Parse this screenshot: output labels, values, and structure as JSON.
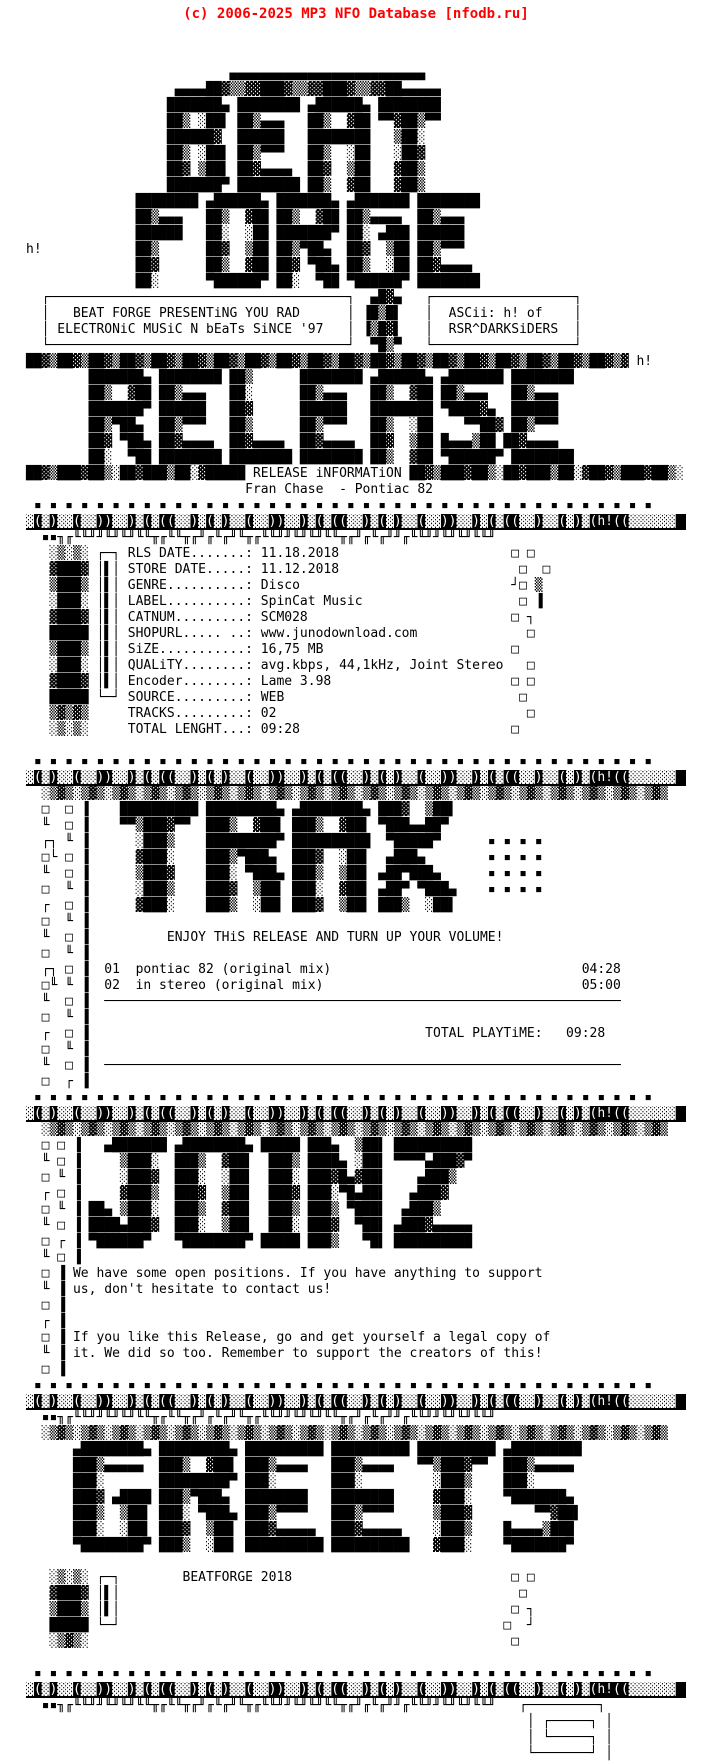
{
  "header": {
    "copyright": "(c) 2006-2025 MP3 NFO Database [nfodb.ru]",
    "color": "#ff0000"
  },
  "colors": {
    "ink": "#000000",
    "paper": "#ffffff",
    "header_red": "#ff0000"
  },
  "ascii_credit": {
    "banner_words": [
      "beat",
      "forge",
      "release",
      "trax",
      "joinz",
      "greets"
    ],
    "artist_tag": "h!",
    "ascii_by": "ASCii: h! of",
    "group": "RSR^DARKSiDERS"
  },
  "intro": {
    "line1": "BEAT FORGE PRESENTiNG YOU RAD",
    "line2": "ELECTRONiC MUSiC N bEaTs SiNCE '97"
  },
  "release": {
    "section_label": "RELEASE iNFORMATiON",
    "artist": "Fran Chase",
    "title": "Pontiac 82",
    "fields": [
      {
        "label": "RLS DATE",
        "value": "11.18.2018"
      },
      {
        "label": "STORE DATE",
        "value": "11.12.2018"
      },
      {
        "label": "GENRE",
        "value": "Disco"
      },
      {
        "label": "LABEL",
        "value": "SpinCat Music"
      },
      {
        "label": "CATNUM",
        "value": "SCM028"
      },
      {
        "label": "SHOPURL",
        "value": "www.junodownload.com"
      },
      {
        "label": "SiZE",
        "value": "16,75 MB"
      },
      {
        "label": "QUALiTY",
        "value": "avg.kbps, 44,1kHz, Joint Stereo"
      },
      {
        "label": "Encoder",
        "value": "Lame 3.98"
      },
      {
        "label": "SOURCE",
        "value": "WEB"
      },
      {
        "label": "TRACKS",
        "value": "02"
      },
      {
        "label": "TOTAL LENGHT",
        "value": "09:28"
      }
    ]
  },
  "tracklist": {
    "header": "ENJOY THiS RELEASE AND TURN UP YOUR VOLUME!",
    "tracks": [
      {
        "no": "01",
        "title": "pontiac 82 (original mix)",
        "time": "04:28"
      },
      {
        "no": "02",
        "title": "in stereo (original mix)",
        "time": "05:00"
      }
    ],
    "total_label": "TOTAL PLAYTiME:",
    "total_time": "09:28"
  },
  "joins": {
    "para1_line1": "We have some open positions. If you have anything to support",
    "para1_line2": "us, don't hesitate to contact us!",
    "para2_line1": "If you like this Release, go and get yourself a legal copy of",
    "para2_line2": "it. We did so too. Remember to support the creators of this!"
  },
  "greets": {
    "footer": "BEATFORGE 2018"
  },
  "nfo": {
    "inverse_lines": [
      29,
      45,
      66,
      84,
      102
    ],
    "lines": [
      "",
      "                          ▄▄▄▄▄▄▄▄▄▄▄▄▄▄▄▄▄▄▄▄▄▄▄▄▄",
      "                   ▄▄▄▄██▓▒▒▓▓███▓▒▒▓▓███▓▒▒▓▓██▄▄▄▄▄",
      "                  ███████▄ ████████ ▄██████▄ ████████",
      "                  ██▒ ░██▌ ██▒▄▄▄   ██▒  ▓██ ▀▀▓██▒▀▀",
      "                  ██████▓  ██████   ████████   ▒██░",
      "                  ██▒ ░██▌ ██▒▀▀▀   ██▒  ░██   ░██▓",
      "                  ██▓ ▒██▌ ██▓▄▄▄▄  ██▓  ▒██   ▓██▒",
      "                  ███████▀ ████████ ██▒  ▓██   ▓██▒",
      "              ████████ ▄██████▄ ███████▄ ▄███████ ████████",
      "              ██▒▄▄▄   ██▒  ▓██ ██▒  ▓██ ██▒▄▄▄▄  ██▒▄▄▄",
      "              ██████   ██░  ░██ ███████▀ ██░ ▄███ ██████",
      "h!            ██▒      ██▓  ▒██ ██▒▀██▄  ██▓  ▒██ ██▒▀▀▀",
      "              ██▓      ██▒  ▓██ ██▓ ▀██▄ ██▒  ░██ ██▓▄▄▄▄",
      "              ██░      ▀██████▀ ██░  ▀██ ▀██████▀ ████████",
      "  ┌──────────────────────────────────────┐  ▄█▓▄   ┌──────────────────┐",
      "  │   BEAT FORGE PRESENTiNG YOU RAD      │ ▐█▒█▌   │  ASCii: h! of    │",
      "  │ ELECTRONiC MUSiC N bEaTs SiNCE '97   │ ▐▒█▓▌   │  RSR^DARKSiDERS  │",
      "  └──────────────────────────────────────┘  ▀█▒▀   └──────────────────┘",
      "██▓▒██▓▒██▓▒██▓▒██▓▒██▓▒██▓▒██▓▒██▓▒██▓▒██▓▒██▓▒██▓▒██▓▒██▓▒██▓▒██▓▒██▓▒██▓▒▓ h!",
      "        ███████▄ ████████ ██▒      ████████ ▄██████▄ ▄███████ ████████",
      "        ██▒  ▓██ ██▒▄▄▄   ██░      ██▒▄▄▄   ██▒  ▓██ ██▒▄▄▄   ██▒▄▄▄",
      "        ███████▀ ██████   ██▓      ██████   ████████ ▀████▓▄  ██████",
      "        ██▒▀██▄  ██▒▀▀▀   ██▒      ██▒▀▀▀   ██▒  ░██    ▀▀██▓ ██▒▀▀▀",
      "        ██▓ ▀██▄ ██▓▄▄▄▄  ██▓▄▄▄▄  ██▓▄▄▄▄  ██▓  ▒██ █▄▄▄▒██ ██▓▄▄▄▄",
      "        ██░  ▀██ ████████ ████████ ████████ ██▒  ▓██ ▀██████▀ ████████",
      "██▓▒███▓██▒░██▓███▒██░▓█████ RELEASE iNFORMATiON ██▓▒███▓██▒░██▓███▒██░▓██▓▒███▓██▒░",
      "                            Fran Chase  - Pontiac 82",
      " ▪ ▪ ▪ ▪ ▪ ▪ ▪ ▪ ▪ ▪ ▪ ▪ ▪ ▪ ▪ ▪ ▪ ▪ ▪ ▪ ▪ ▪ ▪ ▪ ▪ ▪ ▪ ▪ ▪ ▪ ▪ ▪ ▪ ▪ ▪ ▪ ▪ ▪ ▪ ▪",
      "▓(▓)▓▓(▓▓))▓▓)▓(▓((▓▓)▓(▓)▓▓(▓▓))▓▓)▓(▓((▓▓)▓(▓)▓▓(▓▓))▓▓)▓(▓((▓▓)▓▓(▓)▓(h!((▓▓▓▓▓▓",
      "  ▪▪╖╓╙╙╜╜╙╜╙╜╙╙╥╓╙╙╥╓╜╓╙╓╜╙╥╓╙╙╜╜╙╜╙╜╙╙╥╓╜╓╙╓╜╜╓╙╙╜╜╙╜╙╜╙╙╜",
      "   ░▒░▒░ ┌─┐ RLS DATE.......: 11.18.2018                      □ □",
      "   ▓███▓ │▌│ STORE DATE.....: 11.12.2018                       □  □",
      "   ▒███▒ │▌│ GENRE..........: Disco                           ┘□ ▒",
      "   ░███░ │▌│ LABEL..........: SpinCat Music                    □ ▐",
      "   ▓███▓ │▌│ CATNUM.........: SCM028                          □ ┐",
      "   █████ │▌│ SHOPURL..... ..: www.junodownload.com              □",
      "   ▒███▒ │▌│ SiZE...........: 16,75 MB                        □",
      "   ░███░ │▌│ QUALiTY........: avg.kbps, 44,1kHz, Joint Stereo   □",
      "   ▓███▓ │▌│ Encoder........: Lame 3.98                       □ □",
      "   █████ └─┘ SOURCE.........: WEB                              □",
      "   ▒▓▒▓▒     TRACKS.........: 02                                □",
      "   ░▒░▒░     TOTAL LENGHT...: 09:28                           □",
      "",
      " ▪ ▪ ▪ ▪ ▪ ▪ ▪ ▪ ▪ ▪ ▪ ▪ ▪ ▪ ▪ ▪ ▪ ▪ ▪ ▪ ▪ ▪ ▪ ▪ ▪ ▪ ▪ ▪ ▪ ▪ ▪ ▪ ▪ ▪ ▪ ▪ ▪ ▪ ▪ ▪",
      "▓(▓)▓▓(▓▓))▓▓)▓(▓((▓▓)▓(▓)▓▓(▓▓))▓▓)▓(▓((▓▓)▓(▓)▓▓(▓▓))▓▓)▓(▓((▓▓)▓▓(▓)▓(h!((▓▓▓▓▓▓",
      "  ░▒▓▒░▒▓▒░▒▓▒░▒▓▒░▒▓▒░▒▓▒░▒▓▒░▒▓▒░▒▓▒░▒▓▒░▒▓▒░▒▓▒░▒▓▒░▒▓▒░▒▓▒░▒▓▒░▒▓▒░▒▓▒░▒▓▒░▒▓▒",
      "  □  □ ▐    ██████████ █████████▄ ▄████████▄ ███▓  ▒██▌",
      "  ╙  □ ▐    ▀▀▒███▓▀▀  ███▒  ▓██▌ ███▒  ▓██▌ ▀███▄▄██▀",
      "  ┌┐ ╙ ▐      ░███▒    █████████▀ ██████████  ▀█████▀      ▪ ▪ ▪ ▪",
      "  □└ □ ▐      ▓███░    ███▒▀███▄  ███▓  ░██▌  ▄███▄        ▪ ▪ ▪ ▪",
      "  ╙  □ ▐      ▒███▓    ███░ ▀███▄ ███▒  ▒██▌ ▄██▀███▄      ▪ ▪ ▪ ▪",
      "  □  ╙ ▐      ░███▒    ███▓  ▒██▌ ███░  ▓██▌ ▄██▀ ▀███▄    ▪ ▪ ▪ ▪",
      "  ┌  □ ▐      ▓███░    ███▒  ░██▌ ███▓  ▒██▌ ███▒  ░██▌",
      "  □  ╙ ▐",
      "  ╙  □ ▐          ENJOY THiS RELEASE AND TURN UP YOUR VOLUME!",
      "  □  ╙ ▐",
      "  ┌┐ □ ▐  01  pontiac 82 (original mix)                                04:28",
      "  □╙ ╙ ▐  02  in stereo (original mix)                                 05:00",
      "  ╙  □ ▐  ──────────────────────────────────────────────────────────────────",
      "  □  ╙ ▐",
      "  ┌  □ ▐                                           TOTAL PLAYTiME:   09:28",
      "  □  ╙ ▐",
      "  ╙  □ ▐  ──────────────────────────────────────────────────────────────────",
      "  □  ┌ ▐",
      " ▪ ▪ ▪ ▪ ▪ ▪ ▪ ▪ ▪ ▪ ▪ ▪ ▪ ▪ ▪ ▪ ▪ ▪ ▪ ▪ ▪ ▪ ▪ ▪ ▪ ▪ ▪ ▪ ▪ ▪ ▪ ▪ ▪ ▪ ▪ ▪ ▪ ▪ ▪ ▪",
      "▓(▓)▓▓(▓▓))▓▓)▓(▓((▓▓)▓(▓)▓▓(▓▓))▓▓)▓(▓((▓▓)▓(▓)▓▓(▓▓))▓▓)▓(▓((▓▓)▓▓(▓)▓(h!((▓▓▓▓▓▓",
      "  ░▒▓▒░▒▓▒░▒▓▒░▒▓▒░▒▓▒░▒▓▒░▒▓▒░▒▓▒░▒▓▒░▒▓▒░▒▓▒░▒▓▒░▒▓▒░▒▓▒░▒▓▒░▒▓▒░▒▓▒░▒▓▒░▒▓▒░▒▓▒",
      "  □ □ ▐   ▄███████ ▄████████▄ █████ ███▄  ▒██▌ ██████████",
      "  ╙ □ ▐     ▒███░  ███▒  ▓██▌  ███▒ ████▄ ░██▌ ▀▀▀▀▄███▓▀",
      "  □ ╙ ▐     ░███▓  ███░  ░██▌  ███░ ███▓█▄▓██▌    ▄███▒",
      "  ┌ □ ▐     ▓███▒  ███▓  ▒██▌  ███▓ ███░▀█▄██▌   ▄███▓",
      "  □ ╙ ▐ ██▄ ▒███░  ███▒  ▓██▌  ███▒ ███▒ ▀███▌  ▄███▒",
      "  ╙ □ ▐ ████▄███▓  ███░  ▒██▌  ███░ ███▓  ▀██▌ ▄███▓▄▄▄▄▄",
      "  □ ┌ ▐ ▀██████▀   ▀████████▀ █████ ███▒   ▀█▌ ██████████",
      "  ╙ □ ▐",
      "  □ ▐ We have some open positions. If you have anything to support",
      "  ╙ ▐ us, don't hesitate to contact us!",
      "  □ ▐",
      "  ┌ ▐",
      "  □ ▐ If you like this Release, go and get yourself a legal copy of",
      "  ╙ ▐ it. We did so too. Remember to support the creators of this!",
      "  □ ▐",
      " ▪ ▪ ▪ ▪ ▪ ▪ ▪ ▪ ▪ ▪ ▪ ▪ ▪ ▪ ▪ ▪ ▪ ▪ ▪ ▪ ▪ ▪ ▪ ▪ ▪ ▪ ▪ ▪ ▪ ▪ ▪ ▪ ▪ ▪ ▪ ▪ ▪ ▪ ▪ ▪",
      "▓(▓)▓▓(▓▓))▓▓)▓(▓((▓▓)▓(▓)▓▓(▓▓))▓▓)▓(▓((▓▓)▓(▓)▓▓(▓▓))▓▓)▓(▓((▓▓)▓▓(▓)▓(h!((▓▓▓▓▓▓",
      "  ▪▪╖╓╙╙╜╜╙╜╙╜╙╙╥╓╙╙╥╓╜╓╙╓╜╙╥╓╙╙╜╜╙╜╙╜╙╙╥╓╜╓╙╓╜╜╓╙╙╜╜╙╜╙╜╙╙╜",
      "  ░▒▓▒░▒▓▒░▒▓▒░▒▓▒░▒▓▒░▒▓▒░▒▓▒░▒▓▒░▒▓▒░▒▓▒░▒▓▒░▒▓▒░▒▓▒░▒▓▒░▒▓▒░▒▓▒░▒▓▒░▒▓▒░▒▓▒░▒▓▒",
      "      ▄████████▄ █████████▄ ██████████ ██████████ ██████████ ▄█████████",
      "      ███▒▄▄▄▄▄  ███▒  ▓██▌ ███▒▄▄▄▄   ███▒▄▄▄▄   ▀▀▒███▓▀▀  ███▒▄▄▄▄▄",
      "      ███░       █████████▀ ███░       ███░         ░███▒    ███░",
      "      ███▓ ▄████ ███▒▀███▄  ████████   ████████     ▓███░    ▀███████▄",
      "      ███▒  ▒██▌ ███░ ▀███▄ ███▒▀▀▀▀   ███▒▀▀▀▀     ▒███▓        ▀▀▓██▌",
      "      ███░  ░██▌ ███▓  ▒██▌ ███▓▄▄▄▄▄  ███▓▄▄▄▄▄    ░███▒    █▄▄▄▄▒███",
      "      ▀████████▀ ███▒  ░██▌ ██████████ ██████████   ▓███░    ▀███████▀",
      "",
      "   ░▒░▒░ ┌─┐        BEATFORGE 2018                            □ □",
      "   ▓███▓ │▌│                                                   □",
      "   ▒███▒ │▌│                                                  □ ┐",
      "   █████ └─┘                                                 □  ┘",
      "   ░▒▓▒░                                                      □",
      "",
      " ▪ ▪ ▪ ▪ ▪ ▪ ▪ ▪ ▪ ▪ ▪ ▪ ▪ ▪ ▪ ▪ ▪ ▪ ▪ ▪ ▪ ▪ ▪ ▪ ▪ ▪ ▪ ▪ ▪ ▪ ▪ ▪ ▪ ▪ ▪ ▪ ▪ ▪ ▪ ▪",
      "▓(▓)▓▓(▓▓))▓▓)▓(▓((▓▓)▓(▓)▓▓(▓▓))▓▓)▓(▓((▓▓)▓(▓)▓▓(▓▓))▓▓)▓(▓((▓▓)▓▓(▓)▓(h!((▓▓▓▓▓▓",
      "  ▪▪╖╓╙╙╜╜╙╜╙╜╙╙╥╓╙╙╥╓╜╓╙╓╜╙╥╓╙╙╜╜╙╜╙╜╙╙╥╓╜╓╙╓╜╜╓╙╙╜╜╙╜╙╜╙╙╜   ┌─────────┐",
      "                                                                │ ┌─────┐ │",
      "                                                                │ └─────┐ │",
      "                                                                └───────┘ │"
    ]
  }
}
